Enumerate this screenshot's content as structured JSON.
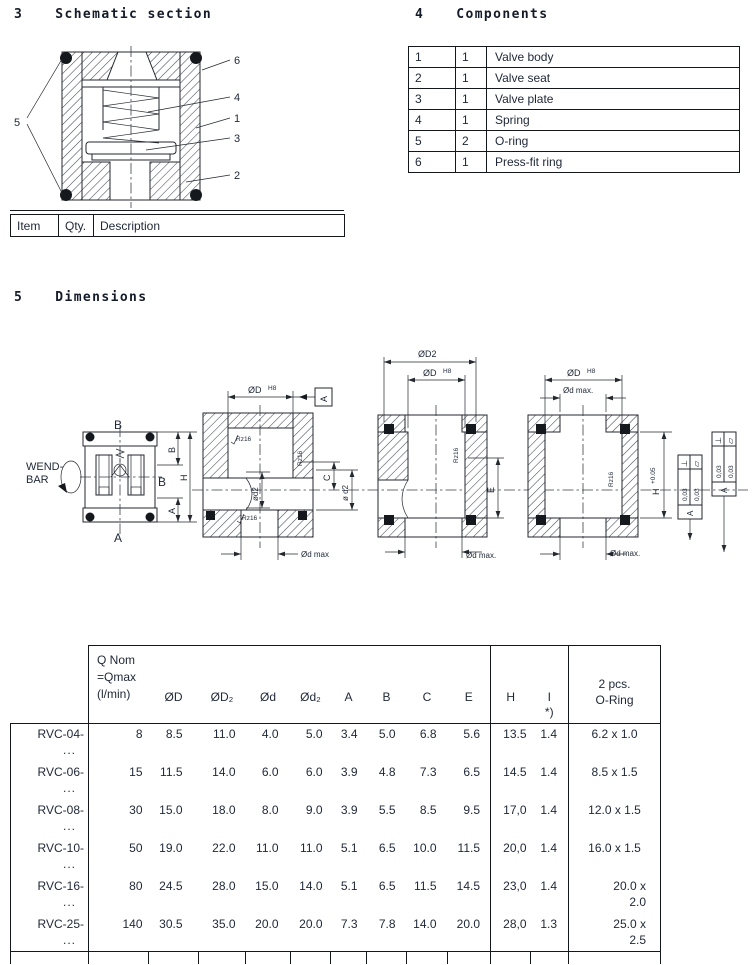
{
  "s3": {
    "number": "3",
    "title": "Schematic section",
    "item_table": {
      "item": "Item",
      "qty": "Qty.",
      "description": "Description"
    }
  },
  "s4": {
    "number": "4",
    "title": "Components",
    "rows": [
      {
        "no": "1",
        "qty": "1",
        "desc": "Valve body"
      },
      {
        "no": "2",
        "qty": "1",
        "desc": "Valve seat"
      },
      {
        "no": "3",
        "qty": "1",
        "desc": "Valve plate"
      },
      {
        "no": "4",
        "qty": "1",
        "desc": "Spring"
      },
      {
        "no": "5",
        "qty": "2",
        "desc": "O-ring"
      },
      {
        "no": "6",
        "qty": "1",
        "desc": "Press-fit ring"
      }
    ]
  },
  "s5": {
    "number": "5",
    "title": "Dimensions"
  },
  "schem": {
    "c1": "1",
    "c2": "2",
    "c3": "3",
    "c4": "4",
    "c5": "5",
    "c6": "6"
  },
  "draw": {
    "front": {
      "wend1": "WEND-",
      "wend2": "BAR",
      "port_top": "B",
      "port_bottom": "A",
      "port_side": "B",
      "dim_b": "B",
      "dim_h": "H",
      "dim_a": "A"
    },
    "v1": {
      "d": "ØD",
      "d_sup": "H8",
      "datum": "A",
      "rz": "Rz16",
      "bore": "ød2",
      "c": "C",
      "d2": "ø d2",
      "dmax": "Ød max"
    },
    "v2": {
      "d2": "ØD2",
      "d": "ØD",
      "d_sup": "H8",
      "rz": "Rz16",
      "e": "E",
      "dmax": "Ød max."
    },
    "v3": {
      "d": "ØD",
      "d_sup": "H8",
      "dmax_top": "Ød max.",
      "rz": "Rz16",
      "h": "H",
      "h_sup": "+0.05",
      "dmax": "Ød max.",
      "perp": "⊥",
      "flat": "▱",
      "tol": "0,03",
      "datum": "A"
    }
  },
  "dim": {
    "header": {
      "q1": "Q Nom",
      "q2": "=Qmax",
      "q3": "(l/min)",
      "od": "ØD",
      "od2": "ØD₂",
      "d": "Ød",
      "dd2": "Ød₂",
      "a": "A",
      "b": "B",
      "c": "C",
      "e": "E",
      "h": "H",
      "i": "I",
      "inote": "*)",
      "or1": "2 pcs.",
      "or2": "O-Ring"
    },
    "rows": [
      {
        "model": "RVC-04-",
        "dots": "...",
        "q": "8",
        "od": "8.5",
        "od2": "11.0",
        "d": "4.0",
        "dd2": "5.0",
        "a": "3.4",
        "b": "5.0",
        "c": "6.8",
        "e": "5.6",
        "h": "13.5",
        "i": "1.4",
        "or1": "6.2 x 1.0",
        "or2": ""
      },
      {
        "model": "RVC-06-",
        "dots": "...",
        "q": "15",
        "od": "11.5",
        "od2": "14.0",
        "d": "6.0",
        "dd2": "6.0",
        "a": "3.9",
        "b": "4.8",
        "c": "7.3",
        "e": "6.5",
        "h": "14.5",
        "i": "1.4",
        "or1": "8.5 x 1.5",
        "or2": ""
      },
      {
        "model": "RVC-08-",
        "dots": "...",
        "q": "30",
        "od": "15.0",
        "od2": "18.0",
        "d": "8.0",
        "dd2": "9.0",
        "a": "3.9",
        "b": "5.5",
        "c": "8.5",
        "e": "9.5",
        "h": "17,0",
        "i": "1.4",
        "or1": "12.0 x 1.5",
        "or2": ""
      },
      {
        "model": "RVC-10-",
        "dots": "...",
        "q": "50",
        "od": "19.0",
        "od2": "22.0",
        "d": "11.0",
        "dd2": "11.0",
        "a": "5.1",
        "b": "6.5",
        "c": "10.0",
        "e": "11.5",
        "h": "20,0",
        "i": "1.4",
        "or1": "16.0 x 1.5",
        "or2": ""
      },
      {
        "model": "RVC-16-",
        "dots": "...",
        "q": "80",
        "od": "24.5",
        "od2": "28.0",
        "d": "15.0",
        "dd2": "14.0",
        "a": "5.1",
        "b": "6.5",
        "c": "11.5",
        "e": "14.5",
        "h": "23,0",
        "i": "1.4",
        "or1": "20.0 x",
        "or2": "2.0"
      },
      {
        "model": "RVC-25-",
        "dots": "...",
        "q": "140",
        "od": "30.5",
        "od2": "35.0",
        "d": "20.0",
        "dd2": "20.0",
        "a": "7.3",
        "b": "7.8",
        "c": "14.0",
        "e": "20.0",
        "h": "28,0",
        "i": "1.3",
        "or1": "25.0 x",
        "or2": "2.5"
      }
    ]
  }
}
